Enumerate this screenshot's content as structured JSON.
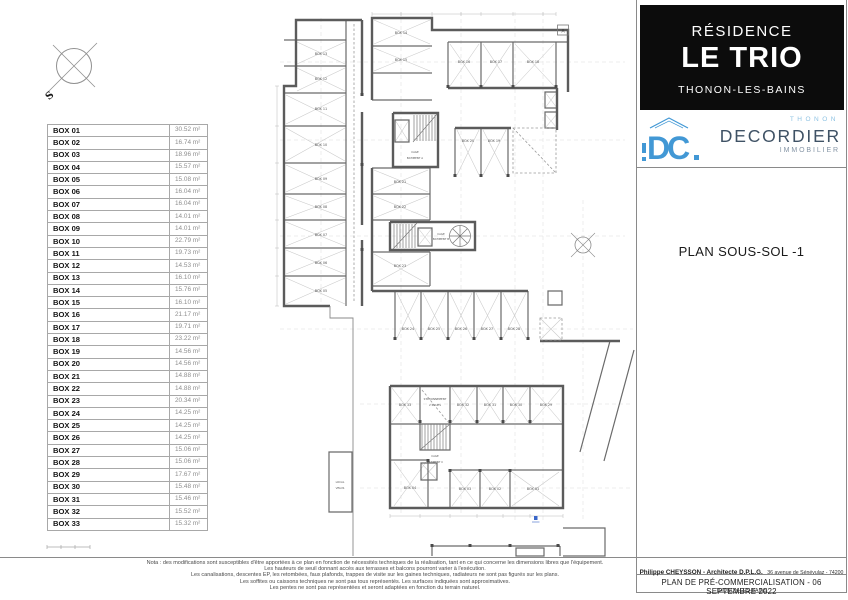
{
  "header": {
    "line1": "RÉSIDENCE",
    "line2": "LE TRIO",
    "line3": "THONON-LES-BAINS"
  },
  "logo": {
    "city": "THONON",
    "brand": "DECORDIER",
    "suffix": "IMMOBILIER",
    "monogram": "DC",
    "blue": "#4298d5",
    "light_blue": "#8fc3e3",
    "dark": "#3f5265"
  },
  "plan_title": "PLAN SOUS-SOL -1",
  "table": {
    "rows": [
      {
        "name": "BOX 01",
        "area": "30.52 m²"
      },
      {
        "name": "BOX 02",
        "area": "16.74 m²"
      },
      {
        "name": "BOX 03",
        "area": "18.96 m²"
      },
      {
        "name": "BOX 04",
        "area": "15.57 m²"
      },
      {
        "name": "BOX 05",
        "area": "15.08 m²"
      },
      {
        "name": "BOX 06",
        "area": "16.04 m²"
      },
      {
        "name": "BOX 07",
        "area": "16.04 m²"
      },
      {
        "name": "BOX 08",
        "area": "14.01 m²"
      },
      {
        "name": "BOX 09",
        "area": "14.01 m²"
      },
      {
        "name": "BOX 10",
        "area": "22.79 m²"
      },
      {
        "name": "BOX 11",
        "area": "19.73 m²"
      },
      {
        "name": "BOX 12",
        "area": "14.53 m²"
      },
      {
        "name": "BOX 13",
        "area": "16.10 m²"
      },
      {
        "name": "BOX 14",
        "area": "15.76 m²"
      },
      {
        "name": "BOX 15",
        "area": "16.10 m²"
      },
      {
        "name": "BOX 16",
        "area": "21.17 m²"
      },
      {
        "name": "BOX 17",
        "area": "19.71 m²"
      },
      {
        "name": "BOX 18",
        "area": "23.22 m²"
      },
      {
        "name": "BOX 19",
        "area": "14.56 m²"
      },
      {
        "name": "BOX 20",
        "area": "14.56 m²"
      },
      {
        "name": "BOX 21",
        "area": "14.88 m²"
      },
      {
        "name": "BOX 22",
        "area": "14.88 m²"
      },
      {
        "name": "BOX 23",
        "area": "20.34 m²"
      },
      {
        "name": "BOX 24",
        "area": "14.25 m²"
      },
      {
        "name": "BOX 25",
        "area": "14.25 m²"
      },
      {
        "name": "BOX 26",
        "area": "14.25 m²"
      },
      {
        "name": "BOX 27",
        "area": "15.06 m²"
      },
      {
        "name": "BOX 28",
        "area": "15.06 m²"
      },
      {
        "name": "BOX 29",
        "area": "17.67 m²"
      },
      {
        "name": "BOX 30",
        "area": "15.48 m²"
      },
      {
        "name": "BOX 31",
        "area": "15.46 m²"
      },
      {
        "name": "BOX 32",
        "area": "15.52 m²"
      },
      {
        "name": "BOX 33",
        "area": "15.32 m²"
      }
    ]
  },
  "plan": {
    "labels": {
      "cage_a1": "CAGE",
      "cage_a2": "BATIMENT A",
      "cage_b1": "CAGE",
      "cage_b2": "BATIMENT B",
      "cage_c1": "CAGE",
      "cage_c2": "BATIMENT C",
      "parking1": "STATIONNEMENT",
      "parking2": "2 ROUES",
      "local1": "LOCAL",
      "local2": "VELOS",
      "axis_a": "A",
      "compass_s": "S"
    }
  },
  "footer": {
    "notes": [
      "Nota : des modifications sont susceptibles d'être apportées à ce plan en fonction de nécessités techniques de la réalisation, tant en ce qui concerne les dimensions libres que l'équipement.",
      "Les hauteurs de seuil donnant accès aux terrasses et balcons pourront varier à l'exécution.",
      "Les canalisations, descentes EP, les retombées, faux plafonds, trappes de visite sur les gaines techniques, radiateurs ne sont pas figurés sur les plans.",
      "Les soffites ou caissons techniques ne sont pas tous représentés. Les surfaces indiquées sont approximatives.",
      "Les pentes ne sont pas représentées et seront adaptées en fonction du terrain naturel."
    ],
    "architect": "Philippe CHEYSSON - Architecte D.P.L.G.",
    "architect_address": "36 avenue de Sénévulaz - 74200 THONON-LES-BAINS",
    "doc_title": "PLAN DE PRÉ-COMMERCIALISATION - 06 SEPTEMBRE 2022"
  }
}
